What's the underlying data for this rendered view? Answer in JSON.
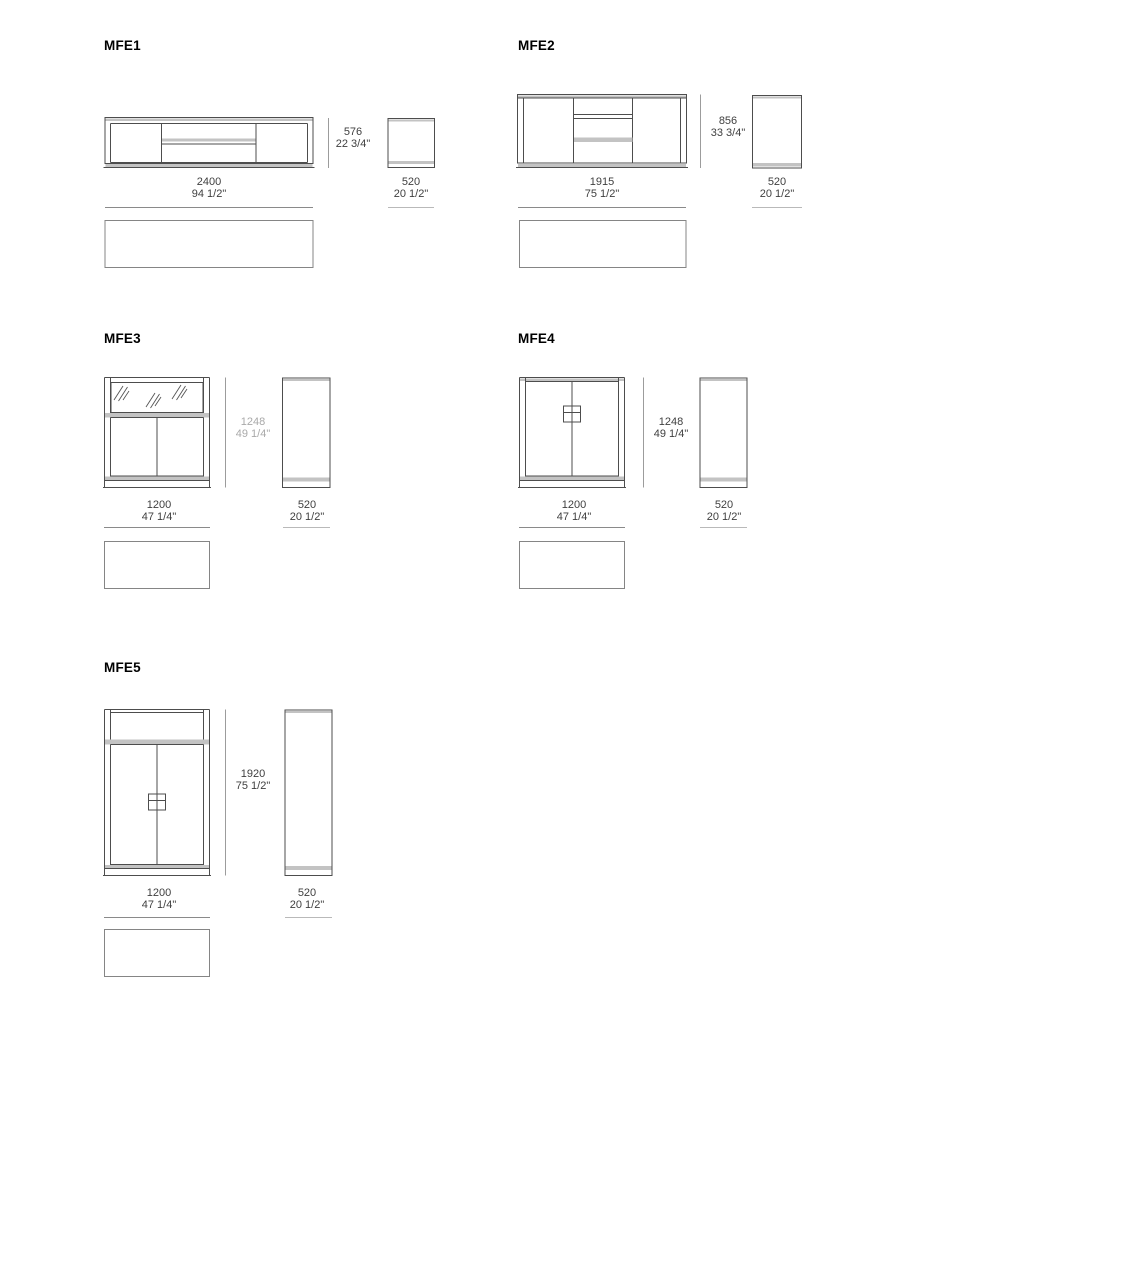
{
  "document": {
    "type": "furniture-dimension-sheet",
    "background": "#ffffff"
  },
  "colors": {
    "structure_line": "#4d4d4d",
    "accent_grey": "#c3c3c3",
    "dimension_line": "#9c9c9c",
    "dimension_text": "#3f3f3f",
    "muted_dimension_text": "#a9a9a9",
    "title_text": "#000000"
  },
  "models": [
    {
      "label": "MFE1",
      "width_mm": "2400",
      "width_in": "94 1/2\"",
      "height_mm": "576",
      "height_in": "22 3/4\"",
      "depth_mm": "520",
      "depth_in": "20 1/2\""
    },
    {
      "label": "MFE2",
      "width_mm": "1915",
      "width_in": "75 1/2\"",
      "height_mm": "856",
      "height_in": "33 3/4\"",
      "depth_mm": "520",
      "depth_in": "20 1/2\""
    },
    {
      "label": "MFE3",
      "width_mm": "1200",
      "width_in": "47 1/4\"",
      "height_mm": "1248",
      "height_in": "49 1/4\"",
      "depth_mm": "520",
      "depth_in": "20 1/2\""
    },
    {
      "label": "MFE4",
      "width_mm": "1200",
      "width_in": "47 1/4\"",
      "height_mm": "1248",
      "height_in": "49 1/4\"",
      "depth_mm": "520",
      "depth_in": "20 1/2\""
    },
    {
      "label": "MFE5",
      "width_mm": "1200",
      "width_in": "47 1/4\"",
      "height_mm": "1920",
      "height_in": "75 1/2\"",
      "depth_mm": "520",
      "depth_in": "20 1/2\""
    }
  ]
}
